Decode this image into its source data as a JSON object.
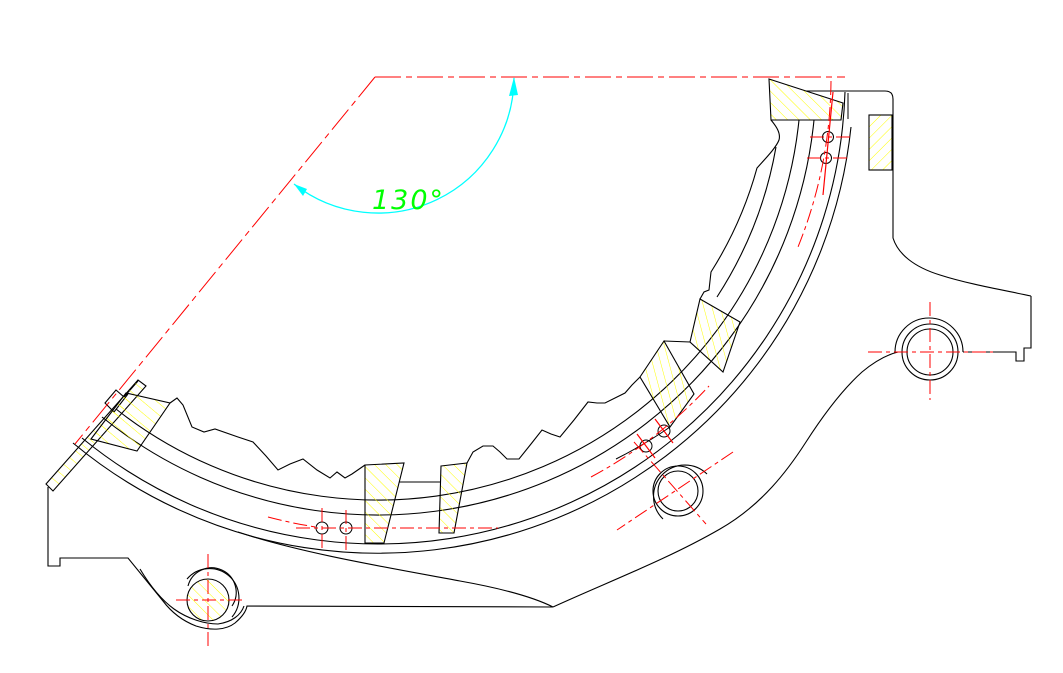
{
  "drawing": {
    "angle_label": "130°",
    "colors": {
      "background": "#ffffff",
      "outline": "#000000",
      "centerline": "#ff0000",
      "dimension": "#00ffff",
      "hatch": "#ffff00",
      "label": "#00ff00"
    }
  }
}
